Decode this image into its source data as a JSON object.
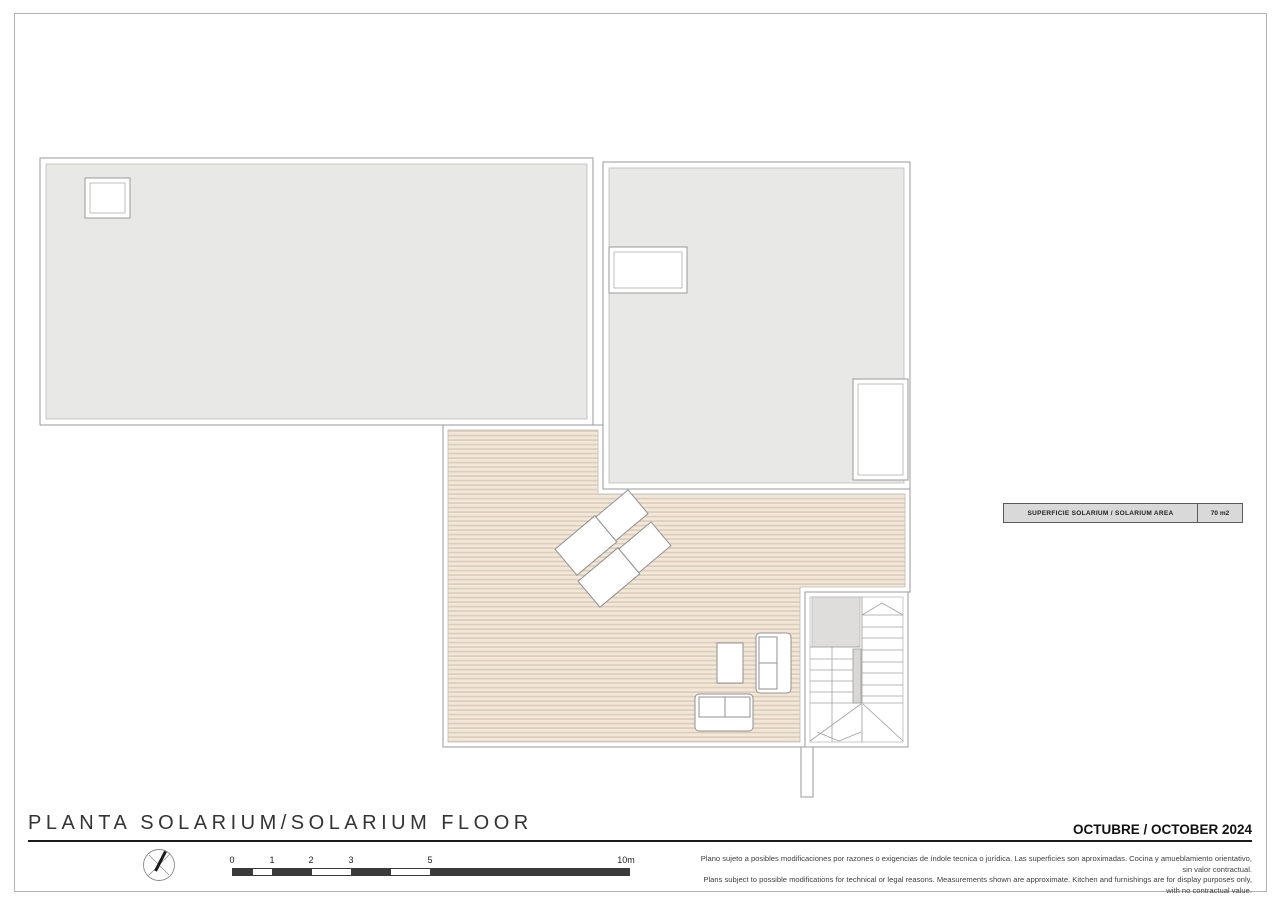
{
  "plan": {
    "colors": {
      "roof_fill": "#e8e8e6",
      "roof_inner_line": "#bcbcbc",
      "deck_light": "#f2e8da",
      "deck_dark": "#dfcfba",
      "outline": "#9a9a9a",
      "stair_gray": "#dedddb"
    },
    "area_label": {
      "name": "SUPERFICIE SOLARIUM / SOLARIUM AREA",
      "value": "70 m2"
    }
  },
  "footer": {
    "title": "PLANTA SOLARIUM/SOLARIUM FLOOR",
    "date": "OCTUBRE / OCTOBER 2024",
    "scale": {
      "labels": [
        "0",
        "1",
        "2",
        "3",
        "5",
        "10m"
      ]
    },
    "disclaimer": {
      "es": "Plano sujeto a posibles modificaciones por razones o exigencias de índole tecnica o jurídica. Las superficies son aproximadas. Cocina y amueblamiento orientativo, sin valor contractual.",
      "en": "Plans subject to possible modifications for technical or legal reasons. Measurements shown are approximate. Kitchen and furnishings are for display purposes only, with no contractual value."
    }
  }
}
